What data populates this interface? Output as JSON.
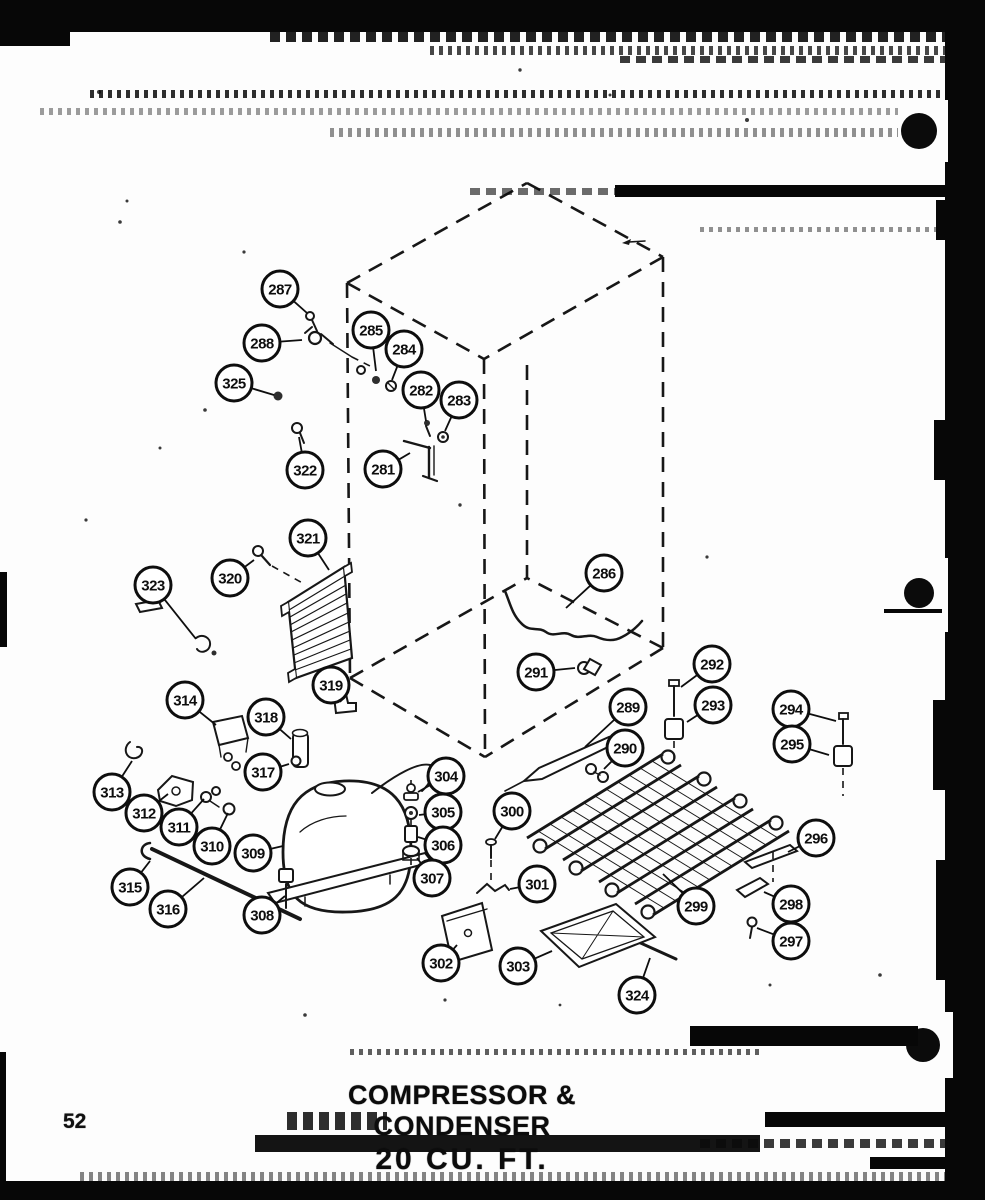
{
  "page": {
    "number": "52",
    "title_line1": "COMPRESSOR & CONDENSER",
    "title_line2": "20 CU. FT.",
    "ink_color": "#111111",
    "paper_color": "#fdfdfd"
  },
  "diagram": {
    "subject": "exploded-view refrigerator compressor and condenser assembly with dashed cabinet outline",
    "callouts": [
      {
        "n": "281",
        "cx": 383,
        "cy": 469,
        "lx": 410,
        "ly": 453
      },
      {
        "n": "282",
        "cx": 421,
        "cy": 390,
        "lx": 426,
        "ly": 421
      },
      {
        "n": "283",
        "cx": 459,
        "cy": 400,
        "lx": 445,
        "ly": 431
      },
      {
        "n": "284",
        "cx": 404,
        "cy": 349,
        "lx": 392,
        "ly": 380
      },
      {
        "n": "285",
        "cx": 371,
        "cy": 330,
        "lx": 376,
        "ly": 371
      },
      {
        "n": "286",
        "cx": 604,
        "cy": 573,
        "lx": 566,
        "ly": 608
      },
      {
        "n": "287",
        "cx": 280,
        "cy": 289,
        "lx": 307,
        "ly": 313
      },
      {
        "n": "288",
        "cx": 262,
        "cy": 343,
        "lx": 302,
        "ly": 340
      },
      {
        "n": "289",
        "cx": 628,
        "cy": 707,
        "lx": 585,
        "ly": 747
      },
      {
        "n": "290",
        "cx": 625,
        "cy": 748,
        "lx": 604,
        "ly": 769
      },
      {
        "n": "291",
        "cx": 536,
        "cy": 672,
        "lx": 575,
        "ly": 668
      },
      {
        "n": "292",
        "cx": 712,
        "cy": 664,
        "lx": 681,
        "ly": 687
      },
      {
        "n": "293",
        "cx": 713,
        "cy": 705,
        "lx": 687,
        "ly": 722
      },
      {
        "n": "294",
        "cx": 791,
        "cy": 709,
        "lx": 836,
        "ly": 721
      },
      {
        "n": "295",
        "cx": 792,
        "cy": 744,
        "lx": 829,
        "ly": 755
      },
      {
        "n": "296",
        "cx": 816,
        "cy": 838,
        "lx": 788,
        "ly": 852
      },
      {
        "n": "297",
        "cx": 791,
        "cy": 941,
        "lx": 757,
        "ly": 928
      },
      {
        "n": "298",
        "cx": 791,
        "cy": 904,
        "lx": 764,
        "ly": 892
      },
      {
        "n": "299",
        "cx": 696,
        "cy": 906,
        "lx": 663,
        "ly": 874
      },
      {
        "n": "300",
        "cx": 512,
        "cy": 811,
        "lx": 495,
        "ly": 839
      },
      {
        "n": "301",
        "cx": 537,
        "cy": 884,
        "lx": 510,
        "ly": 889
      },
      {
        "n": "302",
        "cx": 441,
        "cy": 963,
        "lx": 457,
        "ly": 945
      },
      {
        "n": "303",
        "cx": 518,
        "cy": 966,
        "lx": 552,
        "ly": 951
      },
      {
        "n": "304",
        "cx": 446,
        "cy": 776,
        "lx": 418,
        "ly": 792
      },
      {
        "n": "305",
        "cx": 443,
        "cy": 812,
        "lx": 419,
        "ly": 815
      },
      {
        "n": "306",
        "cx": 443,
        "cy": 845,
        "lx": 418,
        "ly": 837
      },
      {
        "n": "307",
        "cx": 432,
        "cy": 878,
        "lx": 417,
        "ly": 858
      },
      {
        "n": "308",
        "cx": 262,
        "cy": 915,
        "lx": 285,
        "ly": 896
      },
      {
        "n": "309",
        "cx": 253,
        "cy": 853,
        "lx": 283,
        "ly": 846
      },
      {
        "n": "310",
        "cx": 212,
        "cy": 846,
        "lx": 228,
        "ly": 813
      },
      {
        "n": "311",
        "cx": 179,
        "cy": 827,
        "lx": 204,
        "ly": 799
      },
      {
        "n": "312",
        "cx": 144,
        "cy": 813,
        "lx": 168,
        "ly": 794
      },
      {
        "n": "313",
        "cx": 112,
        "cy": 792,
        "lx": 132,
        "ly": 761
      },
      {
        "n": "314",
        "cx": 185,
        "cy": 700,
        "lx": 216,
        "ly": 725
      },
      {
        "n": "315",
        "cx": 130,
        "cy": 887,
        "lx": 150,
        "ly": 861
      },
      {
        "n": "316",
        "cx": 168,
        "cy": 909,
        "lx": 204,
        "ly": 878
      },
      {
        "n": "317",
        "cx": 263,
        "cy": 772,
        "lx": 289,
        "ly": 764
      },
      {
        "n": "318",
        "cx": 266,
        "cy": 717,
        "lx": 291,
        "ly": 739
      },
      {
        "n": "319",
        "cx": 331,
        "cy": 685,
        "lx": 341,
        "ly": 702
      },
      {
        "n": "320",
        "cx": 230,
        "cy": 578,
        "lx": 254,
        "ly": 560
      },
      {
        "n": "321",
        "cx": 308,
        "cy": 538,
        "lx": 329,
        "ly": 570
      },
      {
        "n": "322",
        "cx": 305,
        "cy": 470,
        "lx": 299,
        "ly": 437
      },
      {
        "n": "323",
        "cx": 153,
        "cy": 585,
        "lx": 196,
        "ly": 639
      },
      {
        "n": "324",
        "cx": 637,
        "cy": 995,
        "lx": 650,
        "ly": 958
      },
      {
        "n": "325",
        "cx": 234,
        "cy": 383,
        "lx": 274,
        "ly": 395
      }
    ]
  }
}
